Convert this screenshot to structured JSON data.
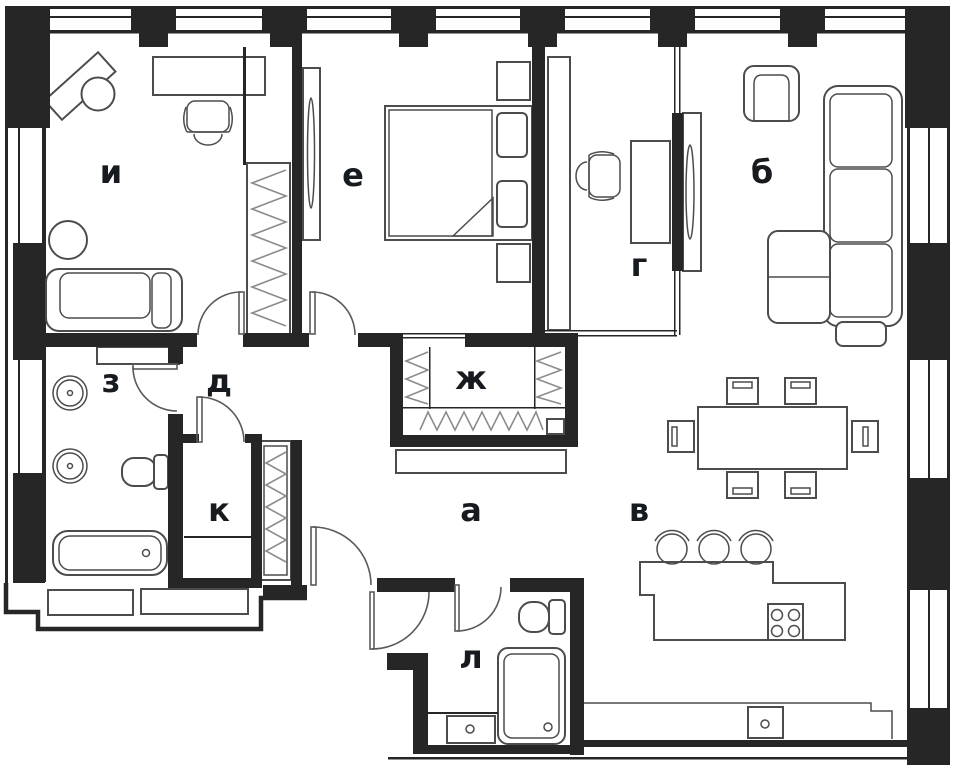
{
  "rooms": [
    {
      "id": "i",
      "label": "и"
    },
    {
      "id": "e",
      "label": "е"
    },
    {
      "id": "b",
      "label": "б"
    },
    {
      "id": "g",
      "label": "г"
    },
    {
      "id": "zh",
      "label": "ж"
    },
    {
      "id": "d",
      "label": "д"
    },
    {
      "id": "z",
      "label": "з"
    },
    {
      "id": "k",
      "label": "к"
    },
    {
      "id": "a",
      "label": "а"
    },
    {
      "id": "v",
      "label": "в"
    },
    {
      "id": "l",
      "label": "л"
    }
  ],
  "colors": {
    "wall": "#262626",
    "furniture": "#4c4c4c",
    "rail": "#8c8c8c",
    "door": "#5a5a5a",
    "label": "#171b20",
    "background": "#ffffff"
  }
}
